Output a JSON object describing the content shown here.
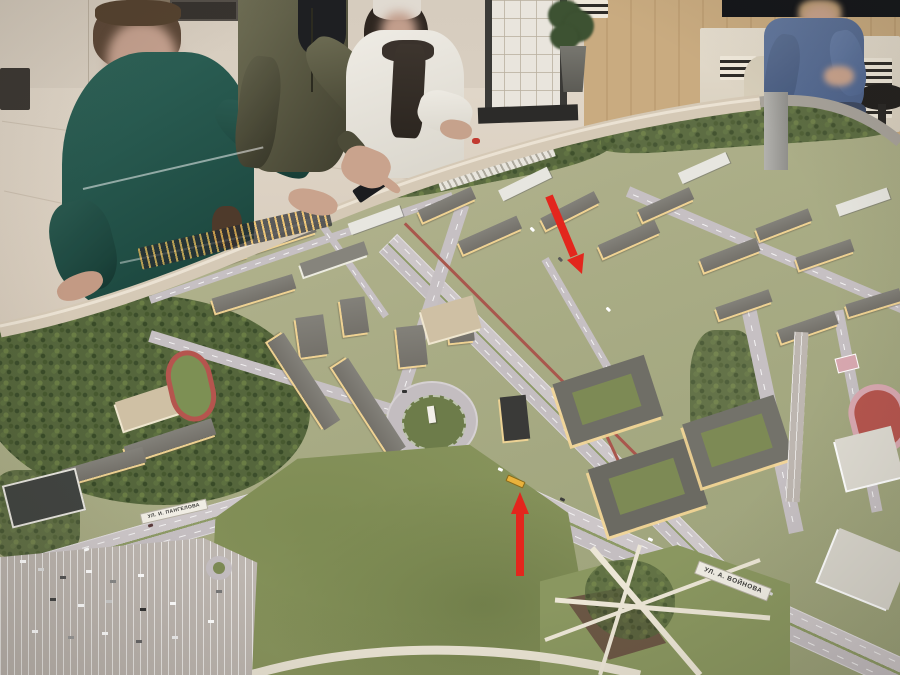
{
  "scene": {
    "type": "photograph",
    "subject": "visitors studying an illuminated architectural scale model of a city district in a showroom"
  },
  "model": {
    "street_labels": [
      {
        "text": "УЛ. И. ПАНГЕЛОВА"
      },
      {
        "text": "УЛ. А. ВОЙНОВА"
      }
    ],
    "annotations": {
      "arrow_color": "#e3261d",
      "arrow_1_target": "avenue-intersection",
      "arrow_2_target": "yellow-bus"
    },
    "colors": {
      "grass": "#a9ac85",
      "forest": "#4e5f38",
      "road": "#c6c0c3",
      "lit_window": "#f2c87e",
      "track_red": "#b5554e",
      "bus_yellow": "#eab23c",
      "rim": "#d5c9b6"
    }
  },
  "people": {
    "left_woman": "standing, teal sweater",
    "center_man": "standing, olive jacket, pointing",
    "right_woman": "standing, white fleece jacket",
    "seated_man": "seated, denim jacket"
  }
}
